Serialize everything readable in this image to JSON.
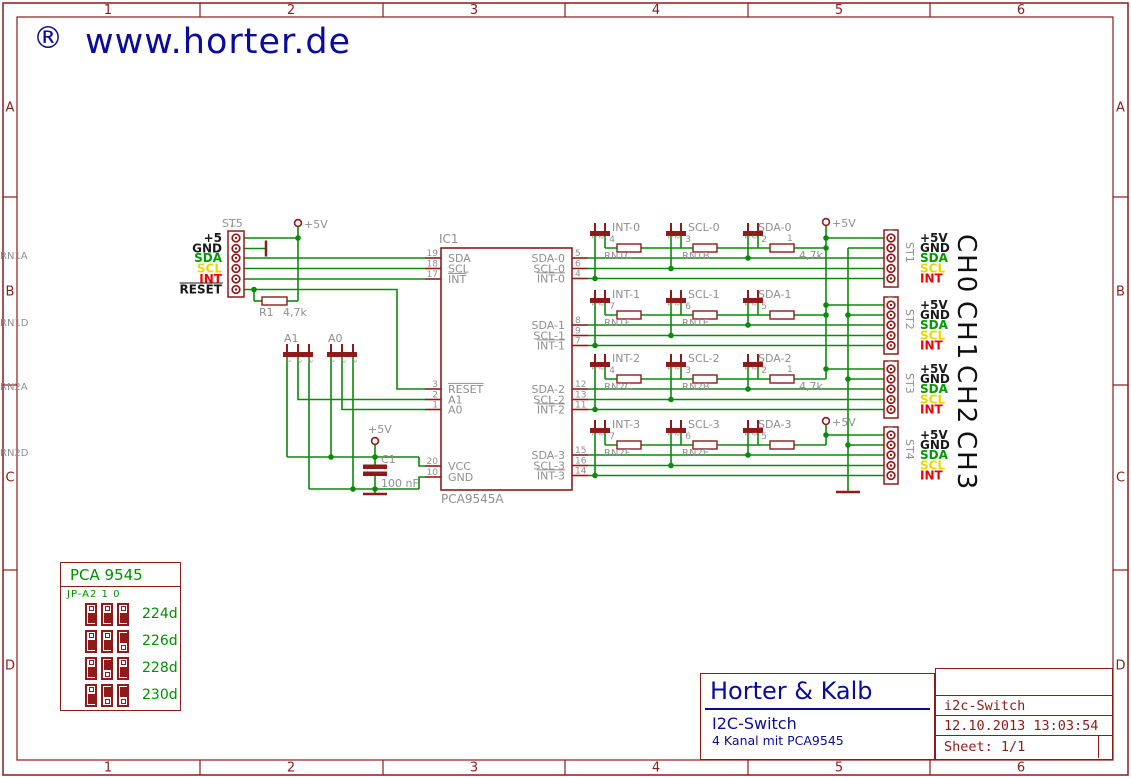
{
  "logo": {
    "mark": "®",
    "text": "www.horter.de"
  },
  "frame": {
    "columns": [
      "1",
      "2",
      "3",
      "4",
      "5",
      "6"
    ],
    "rows": [
      "A",
      "B",
      "C",
      "D"
    ]
  },
  "colors": {
    "frame": "#8f1a1a",
    "wire": "#0a8a0a",
    "gray": "#8f8f8f",
    "navy": "#0b0b9e",
    "black": "#1a1a1a",
    "sda_green": "#009b00",
    "scl_yellow": "#e8d800",
    "int_red": "#f50000",
    "table_green": "#009000"
  },
  "schematic": {
    "power_label": "+5V",
    "st5": {
      "designator": "ST5",
      "first_pin": "1",
      "labels": [
        "+5",
        "GND",
        "SDA",
        "SCL",
        "INT",
        "RESET"
      ],
      "label_colors": [
        "black",
        "black",
        "sda_green",
        "scl_yellow",
        "int_red",
        "black"
      ],
      "overlines": [
        false,
        false,
        false,
        false,
        false,
        true
      ]
    },
    "r1": {
      "name": "R1",
      "value": "4,7k"
    },
    "a_jumpers": [
      {
        "name": "A1",
        "pins": [
          "1",
          "2",
          "3"
        ]
      },
      {
        "name": "A0",
        "pins": [
          "1",
          "2",
          "3"
        ]
      }
    ],
    "c1": {
      "name": "C1",
      "value": "100 nF"
    },
    "ic1": {
      "designator": "IC1",
      "value": "PCA9545A",
      "left_pins": [
        {
          "num": "19",
          "name": "SDA",
          "row": "sda",
          "overline": false
        },
        {
          "num": "18",
          "name": "SCL",
          "row": "scl",
          "overline": false
        },
        {
          "num": "17",
          "name": "INT",
          "row": "int",
          "overline": true
        },
        {
          "num": "3",
          "name": "RESET",
          "row": "reset",
          "overline": true
        },
        {
          "num": "2",
          "name": "A1",
          "row": "a1",
          "overline": false
        },
        {
          "num": "1",
          "name": "A0",
          "row": "a0",
          "overline": false
        },
        {
          "num": "20",
          "name": "VCC",
          "row": "vcc",
          "overline": false
        },
        {
          "num": "10",
          "name": "GND",
          "row": "gnd",
          "overline": false
        }
      ]
    },
    "groups": [
      {
        "ch": "CH0",
        "st": "ST1",
        "first_pin": "1",
        "ic_pins": [
          {
            "num": "5",
            "name": "SDA-0",
            "overline": false
          },
          {
            "num": "6",
            "name": "SCL-0",
            "overline": false
          },
          {
            "num": "4",
            "name": "INT-0",
            "overline": true
          }
        ],
        "jumpers": [
          {
            "net": "INT-0",
            "rn": "RN1C",
            "pin": "4"
          },
          {
            "net": "SCL-0",
            "rn": "RN1B",
            "pin": "3"
          },
          {
            "net": "SDA-0",
            "rn": "RN1A",
            "pin": "2",
            "pin2": "1"
          }
        ],
        "value": "4,7k"
      },
      {
        "ch": "CH1",
        "st": "ST2",
        "first_pin": "1",
        "ic_pins": [
          {
            "num": "8",
            "name": "SDA-1",
            "overline": false
          },
          {
            "num": "9",
            "name": "SCL-1",
            "overline": false
          },
          {
            "num": "7",
            "name": "INT-1",
            "overline": true
          }
        ],
        "jumpers": [
          {
            "net": "INT-1",
            "rn": "RN1F",
            "pin": "7"
          },
          {
            "net": "SCL-1",
            "rn": "RN1E",
            "pin": "6"
          },
          {
            "net": "SDA-1",
            "rn": "RN1D",
            "pin": "5"
          }
        ]
      },
      {
        "ch": "CH2",
        "st": "ST3",
        "first_pin": "1",
        "ic_pins": [
          {
            "num": "12",
            "name": "SDA-2",
            "overline": false
          },
          {
            "num": "13",
            "name": "SCL-2",
            "overline": false
          },
          {
            "num": "11",
            "name": "INT-2",
            "overline": true
          }
        ],
        "jumpers": [
          {
            "net": "INT-2",
            "rn": "RN2C",
            "pin": "4"
          },
          {
            "net": "SCL-2",
            "rn": "RN2B",
            "pin": "3"
          },
          {
            "net": "SDA-2",
            "rn": "RN2A",
            "pin": "2",
            "pin2": "1"
          }
        ],
        "value": "4,7k"
      },
      {
        "ch": "CH3",
        "st": "ST4",
        "first_pin": "1",
        "ic_pins": [
          {
            "num": "15",
            "name": "SDA-3",
            "overline": false
          },
          {
            "num": "16",
            "name": "SCL-3",
            "overline": false
          },
          {
            "num": "14",
            "name": "INT-3",
            "overline": true
          }
        ],
        "jumpers": [
          {
            "net": "INT-3",
            "rn": "RN2F",
            "pin": "7"
          },
          {
            "net": "SCL-3",
            "rn": "RN2E",
            "pin": "6"
          },
          {
            "net": "SDA-3",
            "rn": "RN2D",
            "pin": "5"
          }
        ]
      }
    ],
    "st_pin_labels": [
      {
        "text": "+5V",
        "color": "black"
      },
      {
        "text": "GND",
        "color": "black"
      },
      {
        "text": "SDA",
        "color": "sda_green"
      },
      {
        "text": "SCL",
        "color": "scl_yellow"
      },
      {
        "text": "INT",
        "color": "int_red"
      }
    ]
  },
  "address_table": {
    "title": "PCA 9545",
    "header": "JP-A2 1 0",
    "rows": [
      {
        "jumpers": [
          "down",
          "down",
          "down"
        ],
        "value": "224d"
      },
      {
        "jumpers": [
          "down",
          "down",
          "up"
        ],
        "value": "226d"
      },
      {
        "jumpers": [
          "down",
          "up",
          "down"
        ],
        "value": "228d"
      },
      {
        "jumpers": [
          "down",
          "up",
          "up"
        ],
        "value": "230d"
      }
    ]
  },
  "title_block": {
    "company": "Horter & Kalb",
    "doc_title": "I2C-Switch",
    "doc_subtitle": "4 Kanal mit PCA9545",
    "file": "i2c-Switch",
    "timestamp": "12.10.2013 13:03:54",
    "sheet": "Sheet: 1/1"
  }
}
